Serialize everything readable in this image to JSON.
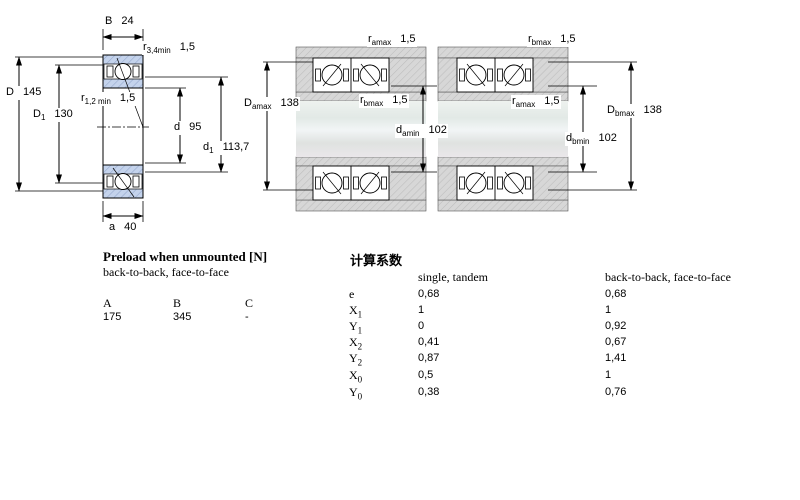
{
  "drawing": {
    "left_figure": {
      "B": {
        "base": "B",
        "value": "24"
      },
      "r34": {
        "base": "r",
        "sub": "3,4min",
        "value": "1,5"
      },
      "D": {
        "base": "D",
        "value": "145"
      },
      "D1": {
        "base": "D",
        "sub": "1",
        "value": "130"
      },
      "r12": {
        "base": "r",
        "sub": "1,2 min",
        "value": "1,5"
      },
      "d": {
        "base": "d",
        "value": "95"
      },
      "d1": {
        "base": "d",
        "sub": "1",
        "value": "113,7"
      },
      "a": {
        "base": "a",
        "value": "40"
      }
    },
    "middle_figure": {
      "ramax": {
        "base": "r",
        "sub": "amax",
        "value": "1,5"
      },
      "Damax": {
        "base": "D",
        "sub": "amax",
        "value": "138"
      },
      "rbmax": {
        "base": "r",
        "sub": "bmax",
        "value": "1,5"
      },
      "damin": {
        "base": "d",
        "sub": "amin",
        "value": "102"
      }
    },
    "right_figure": {
      "rbmax": {
        "base": "r",
        "sub": "bmax",
        "value": "1,5"
      },
      "ramax": {
        "base": "r",
        "sub": "amax",
        "value": "1,5"
      },
      "dbmin": {
        "base": "d",
        "sub": "bmin",
        "value": "102"
      },
      "Dbmax": {
        "base": "D",
        "sub": "bmax",
        "value": "138"
      }
    }
  },
  "preload_table": {
    "title": "Preload when unmounted [N]",
    "subtitle": "back-to-back, face-to-face",
    "columns": [
      "A",
      "B",
      "C"
    ],
    "values": [
      "175",
      "345",
      "-"
    ]
  },
  "factors_table": {
    "title": "计算系数",
    "col1": "single, tandem",
    "col2": "back-to-back, face-to-face",
    "rows": [
      {
        "base": "e",
        "sub": "",
        "v1": "0,68",
        "v2": "0,68"
      },
      {
        "base": "X",
        "sub": "1",
        "v1": "1",
        "v2": "1"
      },
      {
        "base": "Y",
        "sub": "1",
        "v1": "0",
        "v2": "0,92"
      },
      {
        "base": "X",
        "sub": "2",
        "v1": "0,41",
        "v2": "0,67"
      },
      {
        "base": "Y",
        "sub": "2",
        "v1": "0,87",
        "v2": "1,41"
      },
      {
        "base": "X",
        "sub": "0",
        "v1": "0,5",
        "v2": "1"
      },
      {
        "base": "Y",
        "sub": "0",
        "v1": "0,38",
        "v2": "0,76"
      }
    ]
  },
  "colors": {
    "ring_blue": "#c4d3ec",
    "housing_gray": "#d6d6d6",
    "line_black": "#000000"
  }
}
